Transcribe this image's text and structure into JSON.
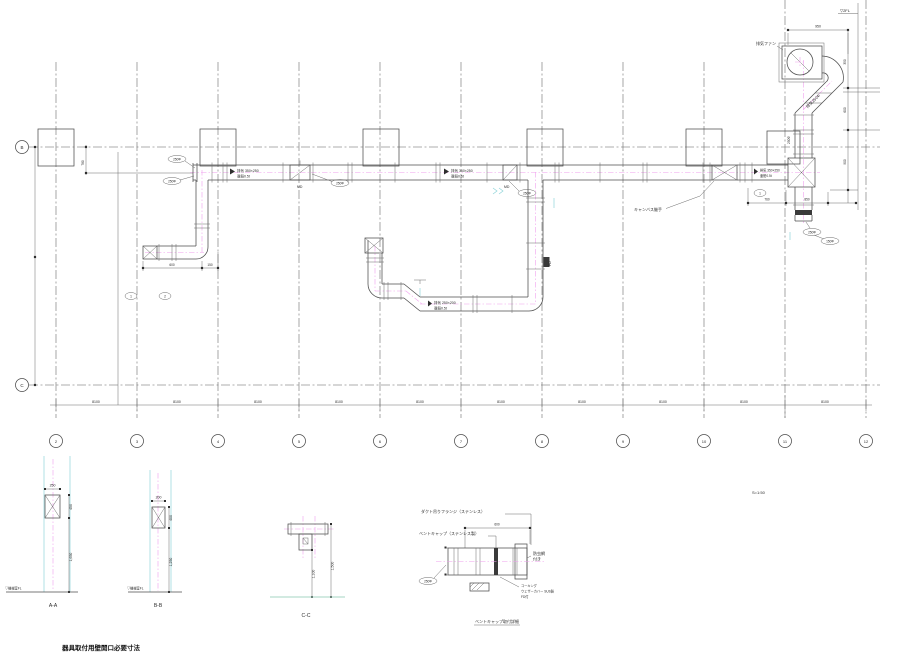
{
  "drawing": {
    "colors": {
      "line": "#4c4c4c",
      "centerline_magenta": "#f0a0ee",
      "guide_cyan": "#8fd4da",
      "ground_teal": "#a5d4c3",
      "background": "#ffffff"
    },
    "grid": {
      "col_labels": [
        "2",
        "3",
        "4",
        "5",
        "6",
        "7",
        "8",
        "9",
        "10",
        "11",
        "12"
      ],
      "row_label_top": "B",
      "row_label_bottom": "C",
      "bay_dim": "8100"
    },
    "plan": {
      "fan_label": "排気ファン",
      "diag_duct_label": "排気250Φ",
      "riser_side_dim": "250Φ",
      "duct_label_1a": "排気 350×250",
      "duct_label_1b": "亜鉛0.5t",
      "duct_label_2a": "排気 350×250",
      "duct_label_2b": "亜鉛0.5t",
      "duct_label_3a": "排気 350×250",
      "duct_label_3b": "亜鉛0.5t",
      "duct_label_4a": "排気 250×200",
      "duct_label_4b": "亜鉛0.5t",
      "md_label_1": "MD",
      "md_label_2": "MD",
      "fd_label": "FD",
      "canvas_note": "キャンバス継手",
      "callout_1": "250Φ",
      "callout_2": "250Φ",
      "callout_3": "250Φ",
      "callout_4": "250Φ",
      "callout_5": "250Φ",
      "callout_6": "150Φ",
      "callout_small_1": "1",
      "callout_small_2": "2",
      "level_mark": "▽2FL",
      "dim_top": "950",
      "dim_r1": "350",
      "dim_r2": "600",
      "dim_r3": "900",
      "dim_br1": "760",
      "dim_br2": "850",
      "dim_bl1": "600",
      "dim_bl2": "150",
      "dim_offset": "780"
    },
    "sections": {
      "a": {
        "label": "A-A",
        "top_dim": "250",
        "dim1": "450",
        "dim2": "1,650",
        "fl": "▽機械室FL"
      },
      "b": {
        "label": "B-B",
        "top_dim": "200",
        "dim1": "400",
        "dim2": "1,250",
        "fl": "▽機械室FL"
      },
      "c": {
        "label": "C-C",
        "dim1": "1,100",
        "dim2": "1,500"
      }
    },
    "detail": {
      "ann1": "ダクト吊りフランジ（ステンレス）",
      "ann2": "ベントキャップ（ステンレス製）",
      "dim": "600",
      "right_note_1": "防虫網",
      "right_note_2": "付き",
      "note3_1": "コーキング",
      "note3_2": "ウェザーカバー SUS製",
      "note3_3": "FD付",
      "callout": "250Φ",
      "label": "ベントキャップ取付詳細"
    },
    "scale_note": "S=1:50",
    "caption": "器具取付用壁開口必要寸法"
  }
}
